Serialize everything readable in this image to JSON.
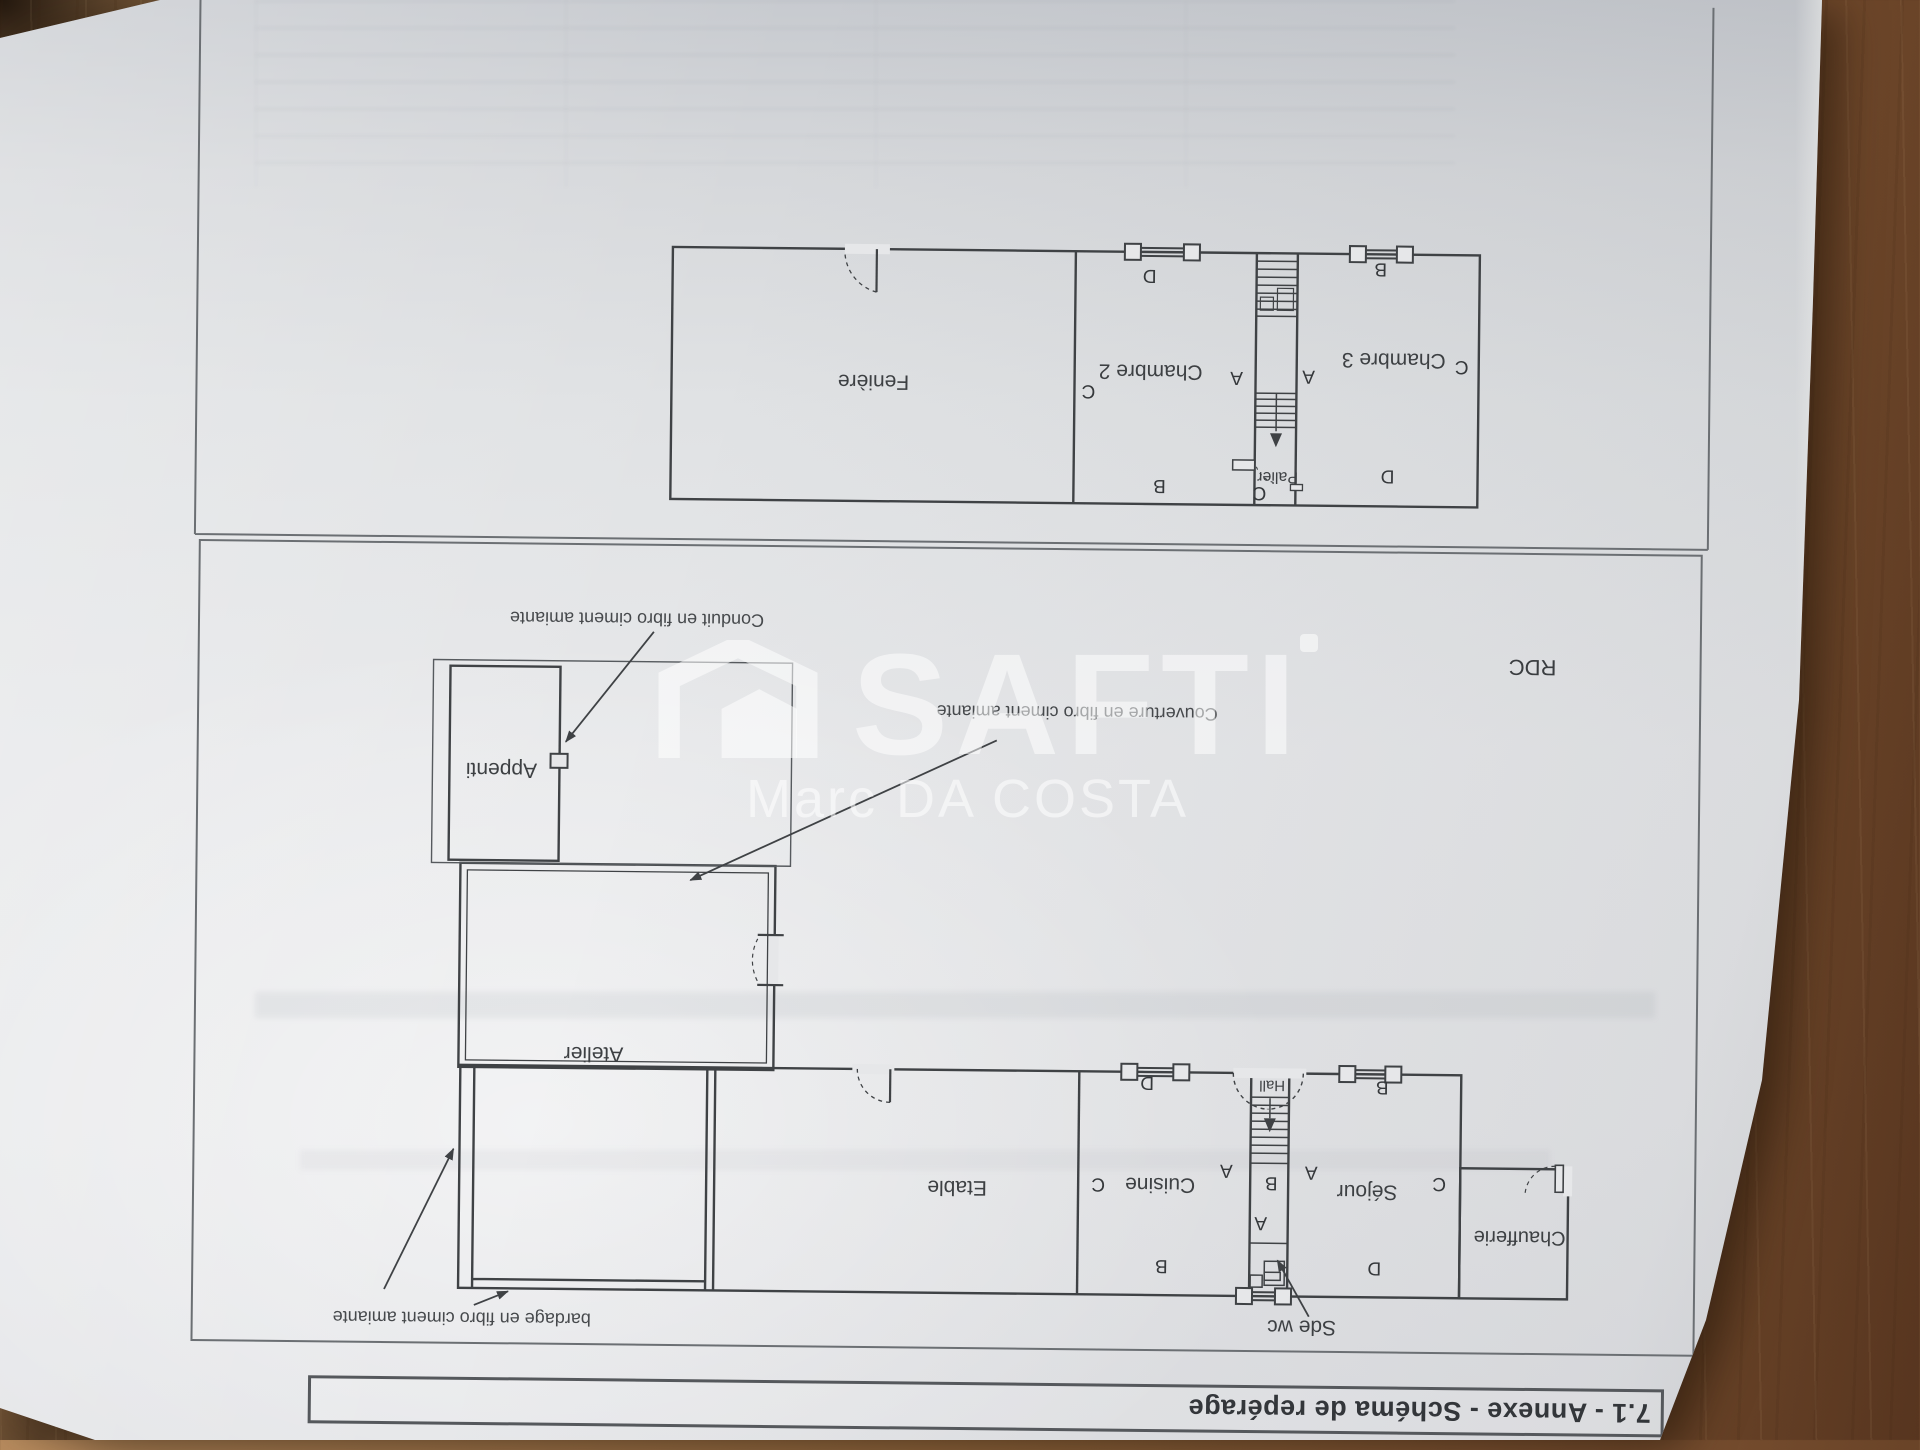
{
  "title_bar": {
    "text": "7.1 - Annexe - Schéma de repérage"
  },
  "watermark": {
    "brand": "SAFTI",
    "agent": "Marc DA COSTA"
  },
  "floor_label": {
    "text": "RDC",
    "x": 388,
    "y": 779
  },
  "plans": {
    "rdc": {
      "rooms": [
        {
          "name": "Etable",
          "x": 958,
          "y": 253
        },
        {
          "name": "Cuisine",
          "x": 755,
          "y": 258
        },
        {
          "name": "Séjour",
          "x": 548,
          "y": 253
        },
        {
          "name": "Chaufferie",
          "x": 395,
          "y": 209,
          "fs": 20
        },
        {
          "name": "Atelier",
          "x": 1323,
          "y": 383
        },
        {
          "name": "Appenti",
          "x": 1418,
          "y": 666
        },
        {
          "name": "Hall",
          "x": 644,
          "y": 358,
          "fs": 15
        },
        {
          "name": "Sde wc",
          "x": 612,
          "y": 117
        }
      ],
      "markers": [
        {
          "letter": "C",
          "x": 817,
          "y": 258
        },
        {
          "letter": "A",
          "x": 689,
          "y": 273
        },
        {
          "letter": "B",
          "x": 644,
          "y": 261
        },
        {
          "letter": "A",
          "x": 604,
          "y": 272
        },
        {
          "letter": "C",
          "x": 476,
          "y": 262
        },
        {
          "letter": "D",
          "x": 769,
          "y": 360
        },
        {
          "letter": "B",
          "x": 534,
          "y": 358
        },
        {
          "letter": "B",
          "x": 753,
          "y": 177
        },
        {
          "letter": "D",
          "x": 540,
          "y": 177
        },
        {
          "letter": "A",
          "x": 654,
          "y": 221
        }
      ]
    },
    "etage": {
      "rooms": [
        {
          "name": "Fenière",
          "x": 1050,
          "y": 1058
        },
        {
          "name": "Chambre 2",
          "x": 773,
          "y": 1071
        },
        {
          "name": "Chambre 3",
          "x": 530,
          "y": 1085
        },
        {
          "name": "Palier",
          "x": 645,
          "y": 967,
          "fs": 16
        }
      ],
      "markers": [
        {
          "letter": "D",
          "x": 775,
          "y": 1167
        },
        {
          "letter": "B",
          "x": 544,
          "y": 1176
        },
        {
          "letter": "C",
          "x": 835,
          "y": 1051
        },
        {
          "letter": "A",
          "x": 687,
          "y": 1066
        },
        {
          "letter": "A",
          "x": 615,
          "y": 1068
        },
        {
          "letter": "C",
          "x": 462,
          "y": 1079
        },
        {
          "letter": "B",
          "x": 763,
          "y": 957
        },
        {
          "letter": "D",
          "x": 535,
          "y": 969
        },
        {
          "letter": "C",
          "x": 663,
          "y": 951
        }
      ]
    }
  },
  "annotations": [
    {
      "text": "Conduit en fibro ciment amiante",
      "x": 1284,
      "y": 818
    },
    {
      "text": "Couverture en fibro ciment amiante",
      "x": 843,
      "y": 729
    },
    {
      "text": "bardage en fibro ciment amiante",
      "x": 1452,
      "y": 117
    }
  ]
}
